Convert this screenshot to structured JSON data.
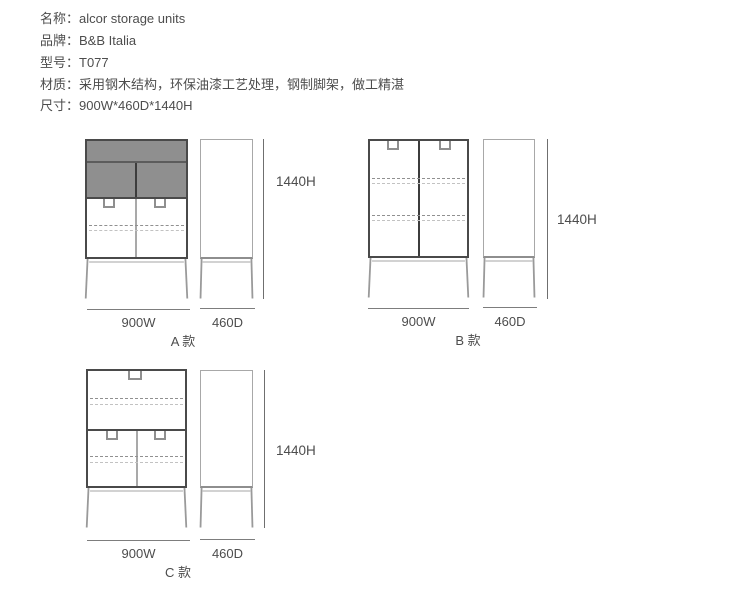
{
  "specs": [
    {
      "text": "名称：alcor storage units"
    },
    {
      "text": "品牌：B&B Italia"
    },
    {
      "text": "型号：T077"
    },
    {
      "text": "材质：采用钢木结构，环保油漆工艺处理，钢制脚架，做工精湛"
    },
    {
      "text": "尺寸：900W*460D*1440H"
    }
  ],
  "figures": {
    "a": {
      "variant": "A 款",
      "width": "900W",
      "depth": "460D",
      "height": "1440H"
    },
    "b": {
      "variant": "B 款",
      "width": "900W",
      "depth": "460D",
      "height": "1440H"
    },
    "c": {
      "variant": "C 款",
      "width": "900W",
      "depth": "460D",
      "height": "1440H"
    }
  },
  "colors": {
    "text": "#4d4d4d",
    "outline_dark": "#4a4a4a",
    "outline_light": "#a8a8a8",
    "panel_gray": "#8f8f8f",
    "panel_divider": "#3c3c3c",
    "door_divider": "#a9a9a9",
    "dash_dark": "#909090",
    "dash_light": "#c2c2c2",
    "handle": "#8f8f8f",
    "leg": "#9a9a9a",
    "stretcher": "#b8b8b8",
    "dim_line": "#6f6f6f",
    "dim_underline": "#7d7d7d"
  }
}
